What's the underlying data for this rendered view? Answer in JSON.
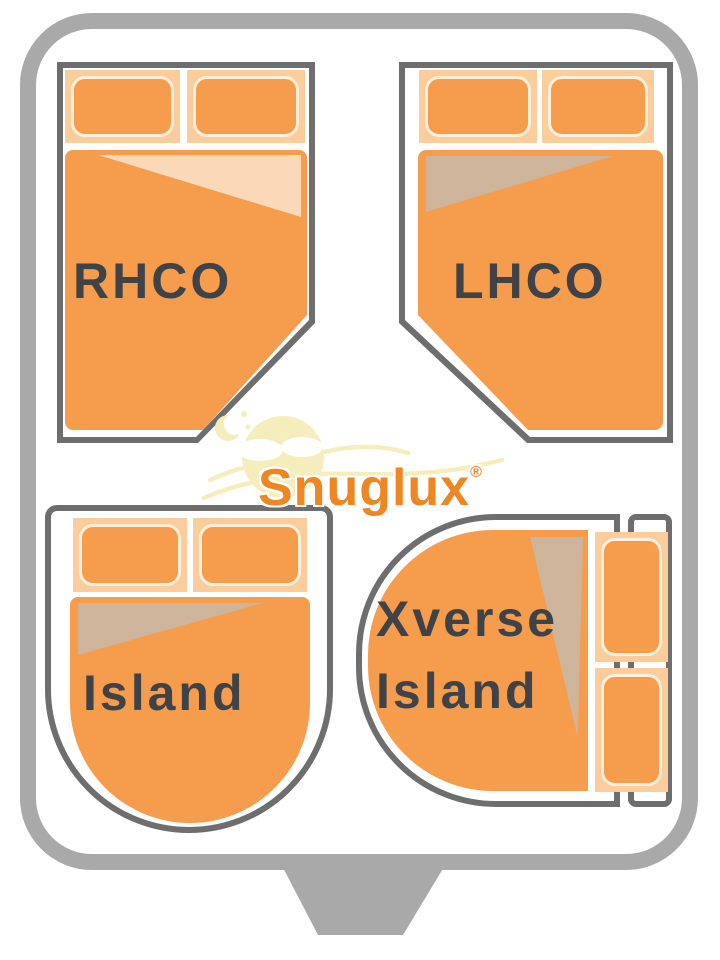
{
  "brand": {
    "name": "Snuglux",
    "registered_mark": "®"
  },
  "beds": [
    {
      "id": "rhco",
      "label": "RHCO",
      "description": "right-hand cut-off corner bed, top-left, pillows at top, cut corner bottom-right"
    },
    {
      "id": "lhco",
      "label": "LHCO",
      "description": "left-hand cut-off corner bed, top-right, pillows at top, cut corner bottom-left"
    },
    {
      "id": "island",
      "label": "Island",
      "description": "island bed, bottom-left, pillows at top, rounded foot end"
    },
    {
      "id": "xverse",
      "label": "Xverse Island",
      "label_lines": [
        "Xverse",
        "Island"
      ],
      "description": "transverse island bed, bottom-right, vertical pillows on right, rounded left end"
    }
  ],
  "colors": {
    "frame_gray": "#A9A9A9",
    "outline_gray": "#6E6E6E",
    "orange": "#F59C4D",
    "pillow_bg": "#FBCD9C",
    "pillow_border": "#FCEFDB",
    "sheet_light": "#FAD8B8",
    "sheet_tan": "#CDB49B",
    "label_text": "#3F4347",
    "logo_orange": "#EF8621",
    "logo_pale": "#F6EDBD"
  }
}
